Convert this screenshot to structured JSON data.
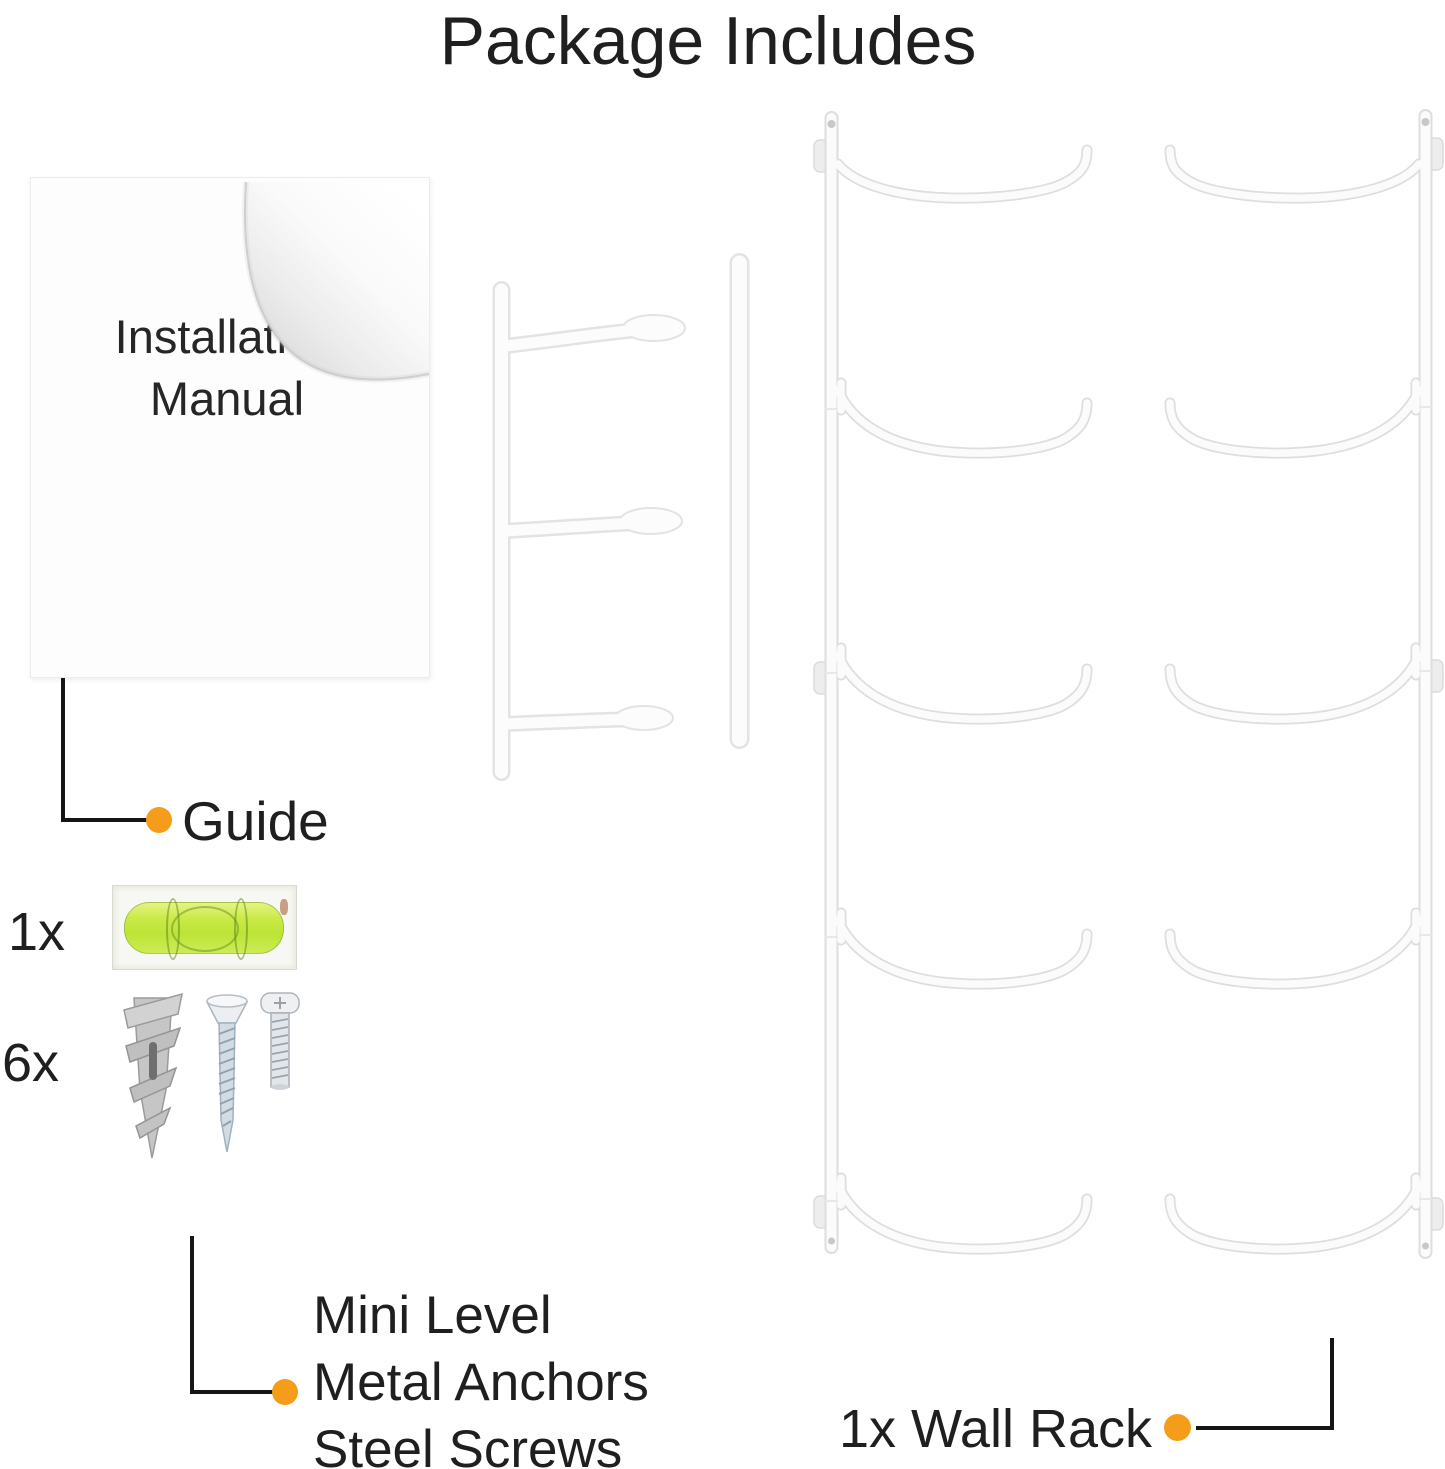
{
  "title": "Package Includes",
  "items": {
    "manual": {
      "line1": "Installation",
      "line2": "Manual"
    },
    "guide": {
      "label": "Guide"
    },
    "level": {
      "qty": "1x"
    },
    "hardware": {
      "qty": "6x",
      "labels": [
        "Mini Level",
        "Metal Anchors",
        "Steel Screws"
      ]
    },
    "rack": {
      "label": "1x Wall Rack"
    }
  },
  "colors": {
    "accent_orange": "#F59D1B",
    "callout_line": "#151515",
    "text": "#1F1F1F",
    "level_green": "#C3E83C",
    "wire_white": "#FBFBFB",
    "wire_edge": "#DEDEDE"
  }
}
